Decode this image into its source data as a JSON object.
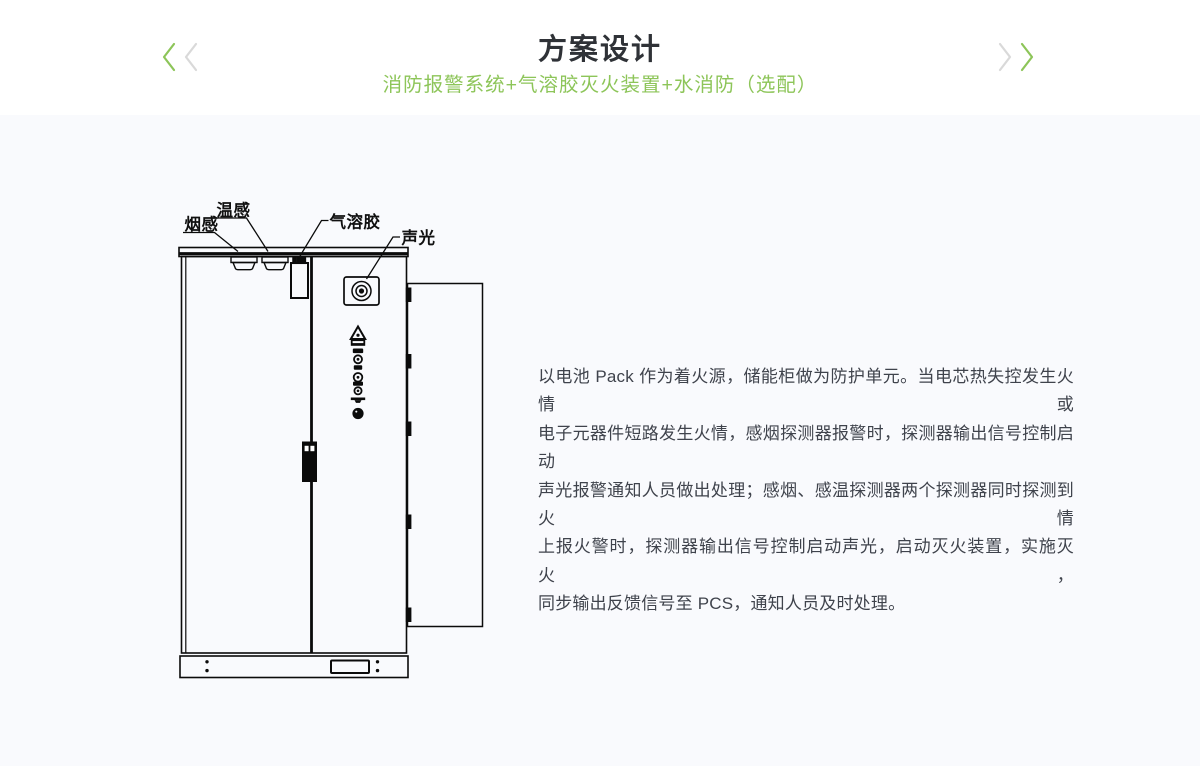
{
  "header": {
    "title": "方案设计",
    "subtitle": "消防报警系统+气溶胶灭火装置+水消防（选配）",
    "nav": {
      "prev_icon": "chevron-left-double",
      "next_icon": "chevron-right-double"
    }
  },
  "colors": {
    "accent_green": "#8dc559",
    "chevron_gray": "#d9d9d9",
    "title_text": "#2f3237",
    "body_text": "#3f434c",
    "content_bg": "#f9fafd",
    "diagram_line": "#0b0b0b"
  },
  "diagram": {
    "labels": [
      {
        "id": "smoke-detector",
        "text": "烟感"
      },
      {
        "id": "temperature-detector",
        "text": "温感"
      },
      {
        "id": "aerosol-device",
        "text": "气溶胶"
      },
      {
        "id": "sound-light-alarm",
        "text": "声光"
      }
    ]
  },
  "main": {
    "paragraph_lines": [
      "以电池 Pack 作为着火源，储能柜做为防护单元。当电芯热失控发生火情或",
      "电子元器件短路发生火情，感烟探测器报警时，探测器输出信号控制启动",
      "声光报警通知人员做出处理；感烟、感温探测器两个探测器同时探测到火情",
      "上报火警时，探测器输出信号控制启动声光，启动灭火装置，实施灭火，",
      "同步输出反馈信号至 PCS，通知人员及时处理。"
    ]
  }
}
